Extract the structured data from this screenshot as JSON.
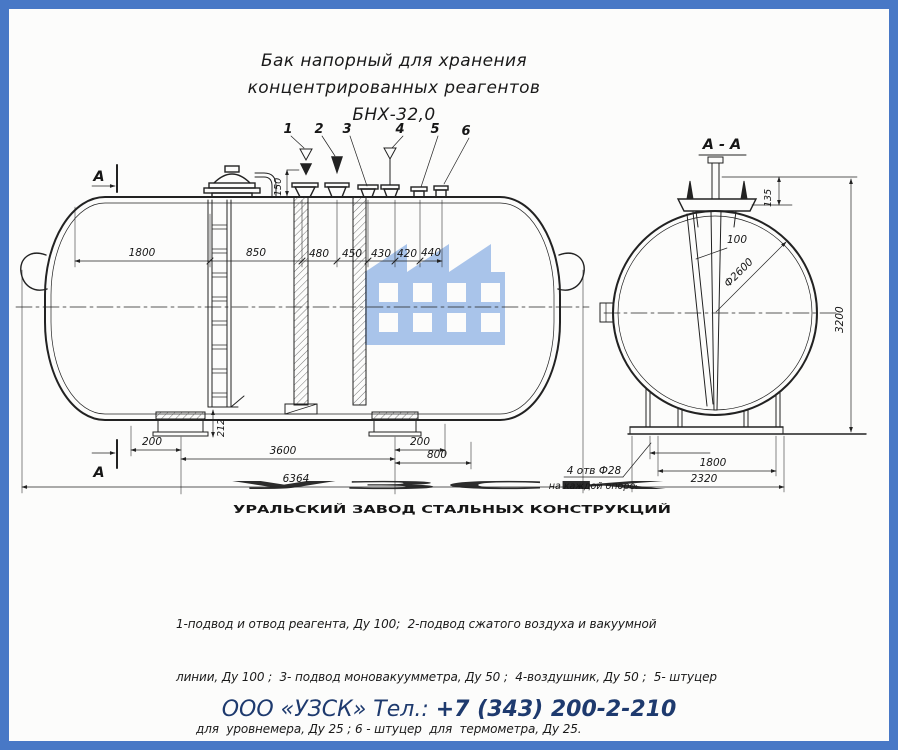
{
  "title": {
    "line1": "Бак напорный для хранения",
    "line2": "концентрированных реагентов БНХ-32,0"
  },
  "watermark": {
    "abbr": "УЗСК",
    "full": "УРАЛЬСКИЙ ЗАВОД СТАЛЬНЫХ КОНСТРУКЦИЙ",
    "building_color": "#a9c4ea",
    "abbr_color": "#99a1b3",
    "full_color": "#4a86e0"
  },
  "main_view": {
    "section_marker": "А",
    "nozzles": [
      "1",
      "2",
      "3",
      "4",
      "5",
      "6"
    ],
    "dim_neck_height": "150",
    "dims_row": [
      "1800",
      "850",
      "480",
      "450",
      "430",
      "420",
      "440"
    ],
    "dim_support": "212",
    "dim_left_offset": "200",
    "dim_span": "3600",
    "dim_right_offset": "200",
    "dim_end": "800",
    "dim_overall": "6364"
  },
  "section_view": {
    "title": "А - А",
    "dim_flange": "135",
    "dim_gap": "100",
    "dim_diameter": "Ф2600",
    "dim_height": "3200",
    "dim_base_inner": "1800",
    "dim_base_outer": "2320",
    "note_line1": "4 отв Ф28",
    "note_line2": "на каждой опоре"
  },
  "legend": {
    "line1": "1-подвод и отвод реагента, Ду 100;  2-подвод сжатого воздуха и вакуумной",
    "line2": "линии, Ду 100 ;  3- подвод моновакуумметра, Ду 50 ;  4-воздушник, Ду 50 ;  5- штуцер",
    "line3": "для  уровнемера, Ду 25 ; 6 - штуцер  для  термометра, Ду 25."
  },
  "footer": {
    "company": "ООО «УЗСК» Тел.:",
    "phone": "+7 (343) 200-2-210",
    "text_color": "#1e3a6e"
  },
  "frame": {
    "border_color": "#4878c6"
  }
}
